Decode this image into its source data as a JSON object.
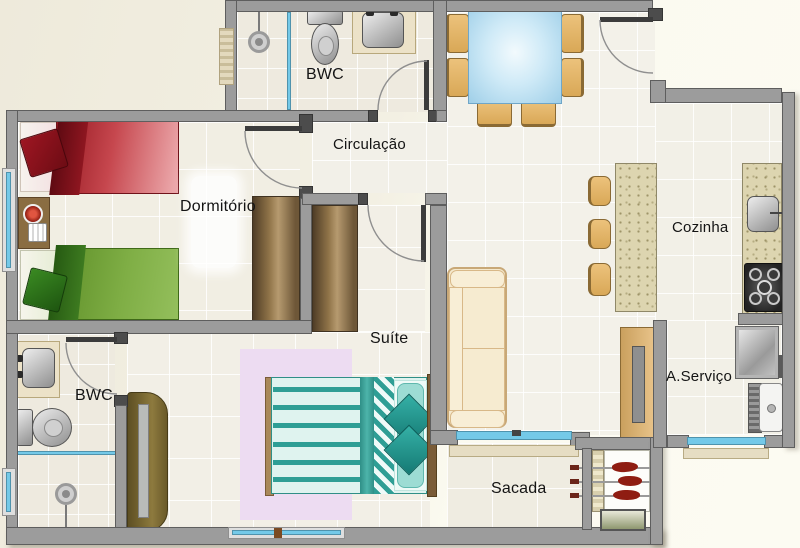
{
  "plan": {
    "type": "apartment-floor-plan",
    "rooms": [
      {
        "id": "bwc-top",
        "label": "BWC"
      },
      {
        "id": "circulacao",
        "label": "Circulação"
      },
      {
        "id": "dormitorio",
        "label": "Dormitório"
      },
      {
        "id": "cozinha",
        "label": "Cozinha"
      },
      {
        "id": "suite",
        "label": "Suíte"
      },
      {
        "id": "bwc-bottom",
        "label": "BWC"
      },
      {
        "id": "area-servico",
        "label": "A.Serviço"
      },
      {
        "id": "sacada",
        "label": "Sacada"
      }
    ],
    "furniture": [
      "single-bed-red",
      "single-bed-green",
      "nightstand",
      "wardrobe-dormitorio",
      "wardrobe-suite",
      "double-bed",
      "rug",
      "sofa",
      "tv-panel",
      "dining-table",
      "dining-chairs",
      "kitchen-island",
      "bar-stools",
      "kitchen-counter",
      "kitchen-sink",
      "stove",
      "washing-machine",
      "laundry-tank",
      "toilet",
      "bathroom-sink",
      "shower",
      "barbecue-grill",
      "suite-closet"
    ],
    "colors": {
      "wall": "#9c9c9c",
      "wall_dark": "#4c4c4c",
      "floor": "#f1eee4",
      "grout": "#ffffff",
      "outside": "#f6f3e6",
      "glass": "#74c9e8",
      "wood_chair": "#e2b169",
      "granite": "#ddd5b0",
      "bed_red": "#a31d27",
      "bed_green": "#79a23a",
      "suite_teal": "#2f9e95",
      "rug_pink": "#eddcf2",
      "wardrobe_brown": "#8a6f49",
      "sofa_cream": "#f5e9cd"
    }
  }
}
